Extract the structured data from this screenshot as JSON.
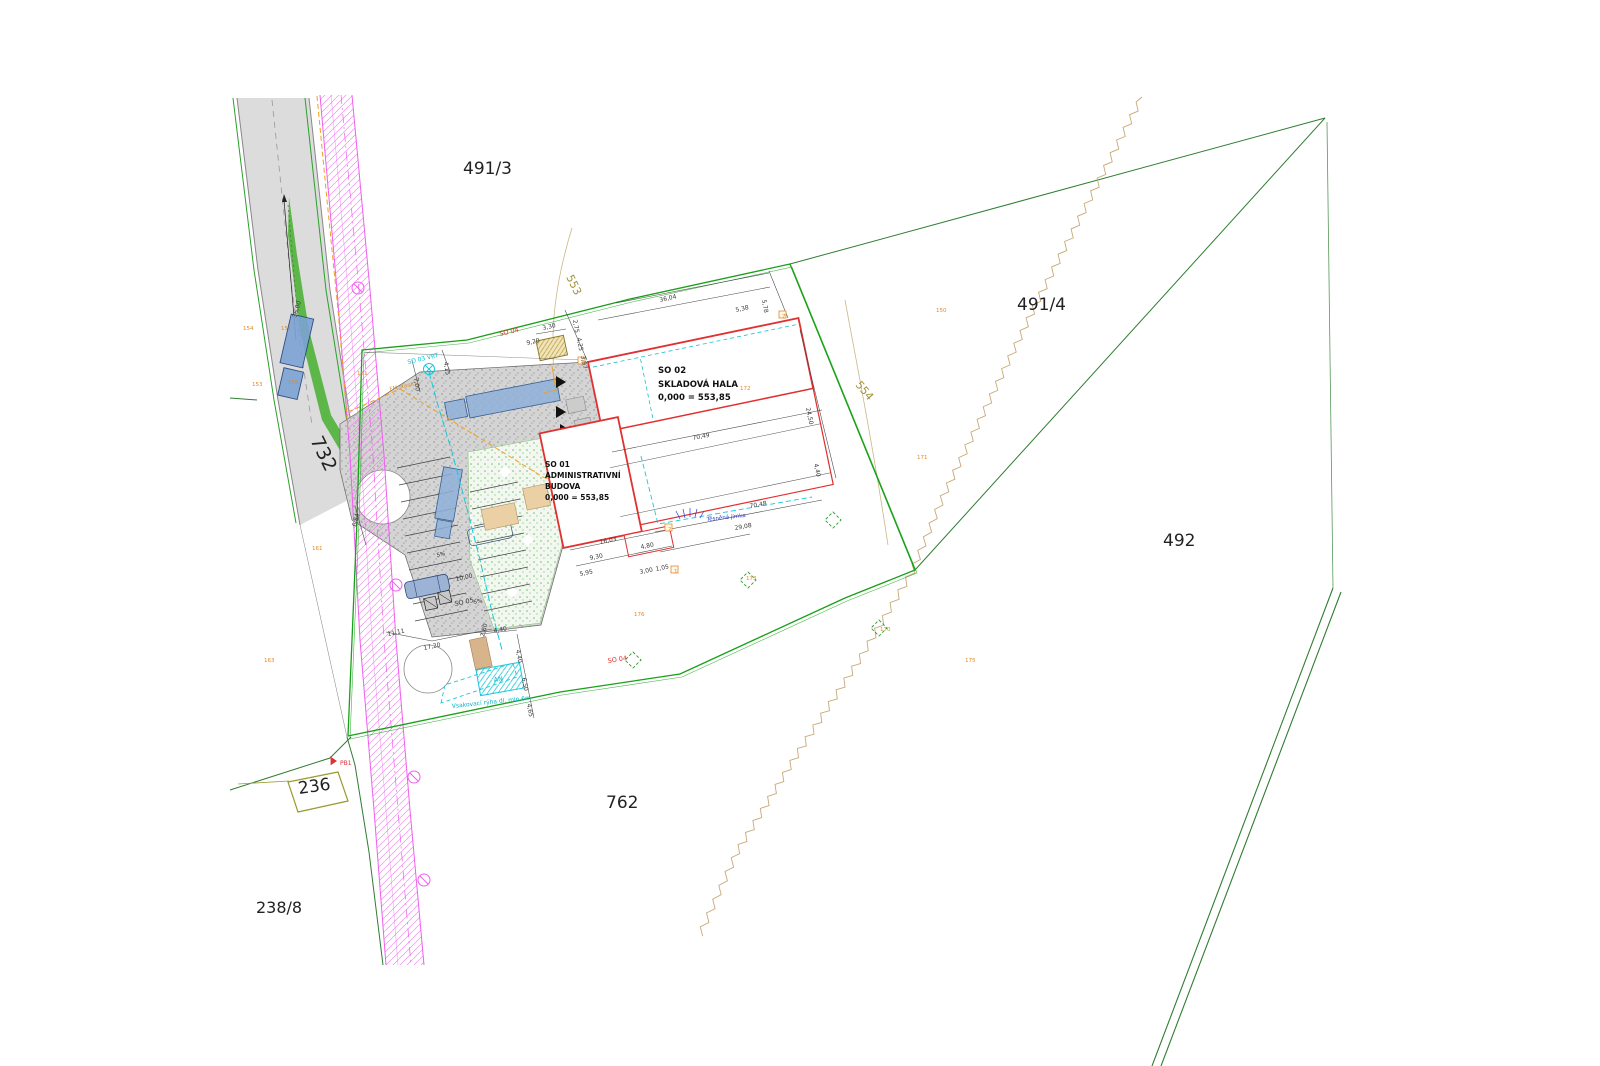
{
  "drawing": {
    "type": "site-plan",
    "colors": {
      "building_outline_red": "#e03030",
      "fence_green": "#18a018",
      "boundary_green": "#2f7d32",
      "utility_magenta": "#ee82ee",
      "gas_orange": "#f0a020",
      "water_cyan": "#18c8dc",
      "survey_orange": "#e08a28",
      "contour_olive": "#a59038",
      "road_gray": "#dcdcdc",
      "vehicle_blue": "#8fb0d8"
    },
    "buildings": {
      "hala": {
        "so": "SO 02",
        "name": "SKLADOVÁ HALA",
        "level": "0,000 = 553,85"
      },
      "admin": {
        "so": "SO 01",
        "name_line1": "ADMINISTRATIVNÍ",
        "name_line2": "BUDOVA",
        "level": "0,000 = 553,85"
      }
    },
    "labels": [
      {
        "t": "491/3",
        "x": 463,
        "y": 174,
        "fs": 17,
        "fill": "#222222",
        "n": "parcel-label-491-3"
      },
      {
        "t": "491/4",
        "x": 1017,
        "y": 310,
        "fs": 17,
        "fill": "#222222",
        "n": "parcel-label-491-4"
      },
      {
        "t": "492",
        "x": 1163,
        "y": 546,
        "fs": 17,
        "fill": "#222222",
        "n": "parcel-label-492"
      },
      {
        "t": "762",
        "x": 606,
        "y": 808,
        "fs": 17,
        "fill": "#222222",
        "n": "parcel-label-762"
      },
      {
        "t": "236",
        "x": 299,
        "y": 794,
        "fs": 17,
        "fill": "#222222",
        "r": -8,
        "n": "parcel-label-236"
      },
      {
        "t": "238/8",
        "x": 256,
        "y": 913,
        "fs": 16,
        "fill": "#222222",
        "n": "parcel-label-238-8"
      },
      {
        "t": "732",
        "x": 310,
        "y": 440,
        "fs": 19,
        "fill": "#222222",
        "r": 64,
        "n": "parcel-label-732"
      },
      {
        "t": "553",
        "x": 566,
        "y": 277,
        "fs": 11,
        "fill": "#a59038",
        "r": 64,
        "n": "contour-label-553"
      },
      {
        "t": "554",
        "x": 855,
        "y": 385,
        "fs": 11,
        "fill": "#a59038",
        "r": 50,
        "n": "contour-label-554"
      },
      {
        "t": "SO 02",
        "x": 658,
        "y": 373,
        "fs": 8.5,
        "b": 1,
        "fill": "#111111",
        "n": "hala-so-number"
      },
      {
        "t": "SKLADOVÁ HALA",
        "x": 658,
        "y": 387,
        "fs": 8.5,
        "b": 1,
        "fill": "#111111",
        "n": "hala-name"
      },
      {
        "t": "0,000 = 553,85",
        "x": 658,
        "y": 400,
        "fs": 8.5,
        "b": 1,
        "fill": "#111111",
        "n": "hala-level"
      },
      {
        "t": "SO 01",
        "x": 545,
        "y": 467,
        "fs": 7.5,
        "b": 1,
        "fill": "#111111",
        "n": "admin-so-number"
      },
      {
        "t": "ADMINISTRATIVNÍ",
        "x": 545,
        "y": 478,
        "fs": 7.5,
        "b": 1,
        "fill": "#111111",
        "n": "admin-name-1"
      },
      {
        "t": "BUDOVA",
        "x": 545,
        "y": 489,
        "fs": 7.5,
        "b": 1,
        "fill": "#111111",
        "n": "admin-name-2"
      },
      {
        "t": "0,000 = 553,85",
        "x": 545,
        "y": 500,
        "fs": 7.5,
        "b": 1,
        "fill": "#111111",
        "n": "admin-level"
      },
      {
        "t": "SO 04",
        "x": 500,
        "y": 336,
        "fs": 6.5,
        "fill": "#e03030",
        "r": -13,
        "n": "fence-label-top"
      },
      {
        "t": "SO 04",
        "x": 608,
        "y": 663,
        "fs": 6.5,
        "fill": "#e03030",
        "r": -9,
        "n": "fence-label-bottom"
      },
      {
        "t": "SO 05",
        "x": 455,
        "y": 606,
        "fs": 6.5,
        "fill": "#333333",
        "r": -12,
        "n": "parking-label"
      },
      {
        "t": "SO 03 VRT",
        "x": 408,
        "y": 364,
        "fs": 6,
        "fill": "#00c5d8",
        "r": -13,
        "n": "well-label"
      },
      {
        "t": "FM stanice",
        "x": 390,
        "y": 391,
        "fs": 5.5,
        "fill": "#e08a28",
        "r": -13,
        "n": "fm-station-label"
      },
      {
        "t": "AN",
        "x": 494,
        "y": 682,
        "fs": 6.5,
        "fill": "#00b5c8",
        "r": -8,
        "n": "tank-label"
      },
      {
        "t": "Vsakovací rýha dl. min 6m",
        "x": 452,
        "y": 708,
        "fs": 6,
        "fill": "#00b5c8",
        "r": -6,
        "n": "infiltration-trench-label"
      },
      {
        "t": "Těsněná jímka",
        "x": 707,
        "y": 521,
        "fs": 5.5,
        "fill": "#2b3fd8",
        "r": -6,
        "n": "cesspit-label"
      },
      {
        "t": "PB1",
        "x": 340,
        "y": 765,
        "fs": 6,
        "fill": "#e03030",
        "n": "benchmark-label"
      },
      {
        "t": "5%",
        "x": 474,
        "y": 604,
        "fs": 5.5,
        "fill": "#333333",
        "r": -12,
        "n": "slope-label"
      },
      {
        "t": "5%",
        "x": 437,
        "y": 557,
        "fs": 5.5,
        "fill": "#333333",
        "r": -12,
        "n": "slope-label"
      }
    ],
    "dims": [
      {
        "t": "36,04",
        "x": 660,
        "y": 302,
        "r": -13
      },
      {
        "t": "5,78",
        "x": 762,
        "y": 300,
        "r": 80
      },
      {
        "t": "5,38",
        "x": 736,
        "y": 312,
        "r": -13
      },
      {
        "t": "2,75",
        "x": 573,
        "y": 320,
        "r": 80
      },
      {
        "t": "4,25",
        "x": 577,
        "y": 338,
        "r": 80
      },
      {
        "t": "3,97",
        "x": 581,
        "y": 356,
        "r": 80
      },
      {
        "t": "3,30",
        "x": 543,
        "y": 330,
        "r": -13
      },
      {
        "t": "9,20",
        "x": 527,
        "y": 345,
        "r": -13
      },
      {
        "t": "70,49",
        "x": 693,
        "y": 440,
        "r": -11
      },
      {
        "t": "70,48",
        "x": 750,
        "y": 508,
        "r": -10
      },
      {
        "t": "29,08",
        "x": 735,
        "y": 530,
        "r": -10
      },
      {
        "t": "24,50",
        "x": 806,
        "y": 408,
        "r": 78
      },
      {
        "t": "4,40",
        "x": 814,
        "y": 464,
        "r": 78
      },
      {
        "t": "36,00",
        "x": 296,
        "y": 318,
        "r": -73
      },
      {
        "t": "6,84",
        "x": 356,
        "y": 527,
        "r": -75
      },
      {
        "t": "11,11",
        "x": 388,
        "y": 636,
        "r": -12
      },
      {
        "t": "17,20",
        "x": 424,
        "y": 650,
        "r": -12
      },
      {
        "t": "2,80",
        "x": 484,
        "y": 637,
        "r": -75
      },
      {
        "t": "4,40",
        "x": 494,
        "y": 633,
        "r": -12
      },
      {
        "t": "4,40",
        "x": 516,
        "y": 650,
        "r": 80
      },
      {
        "t": "6,50",
        "x": 522,
        "y": 678,
        "r": 80
      },
      {
        "t": "4,65",
        "x": 527,
        "y": 704,
        "r": 80
      },
      {
        "t": "10,00",
        "x": 456,
        "y": 581,
        "r": -12
      },
      {
        "t": "16,03",
        "x": 600,
        "y": 544,
        "r": -11
      },
      {
        "t": "4,80",
        "x": 641,
        "y": 549,
        "r": -11
      },
      {
        "t": "9,30",
        "x": 590,
        "y": 560,
        "r": -11
      },
      {
        "t": "5,95",
        "x": 580,
        "y": 576,
        "r": -11
      },
      {
        "t": "3,00",
        "x": 640,
        "y": 574,
        "r": -11
      },
      {
        "t": "1,05",
        "x": 656,
        "y": 571,
        "r": -11
      },
      {
        "t": "7,00",
        "x": 414,
        "y": 378,
        "r": 82
      },
      {
        "t": "4,15",
        "x": 444,
        "y": 362,
        "r": 82
      }
    ],
    "points": [
      {
        "t": "154",
        "x": 243,
        "y": 330
      },
      {
        "t": "151",
        "x": 281,
        "y": 330
      },
      {
        "t": "153",
        "x": 252,
        "y": 386
      },
      {
        "t": "158",
        "x": 288,
        "y": 384
      },
      {
        "t": "151",
        "x": 357,
        "y": 375
      },
      {
        "t": "150",
        "x": 936,
        "y": 312
      },
      {
        "t": "171",
        "x": 917,
        "y": 459
      },
      {
        "t": "172",
        "x": 740,
        "y": 390
      },
      {
        "t": "173",
        "x": 746,
        "y": 580
      },
      {
        "t": "170",
        "x": 880,
        "y": 631
      },
      {
        "t": "175",
        "x": 965,
        "y": 662
      },
      {
        "t": "176",
        "x": 634,
        "y": 616
      },
      {
        "t": "163",
        "x": 264,
        "y": 662
      },
      {
        "t": "161",
        "x": 312,
        "y": 550
      },
      {
        "t": "7",
        "x": 782,
        "y": 318
      },
      {
        "t": "2",
        "x": 668,
        "y": 531
      },
      {
        "t": "1",
        "x": 674,
        "y": 573
      },
      {
        "t": "4",
        "x": 581,
        "y": 364
      }
    ]
  }
}
